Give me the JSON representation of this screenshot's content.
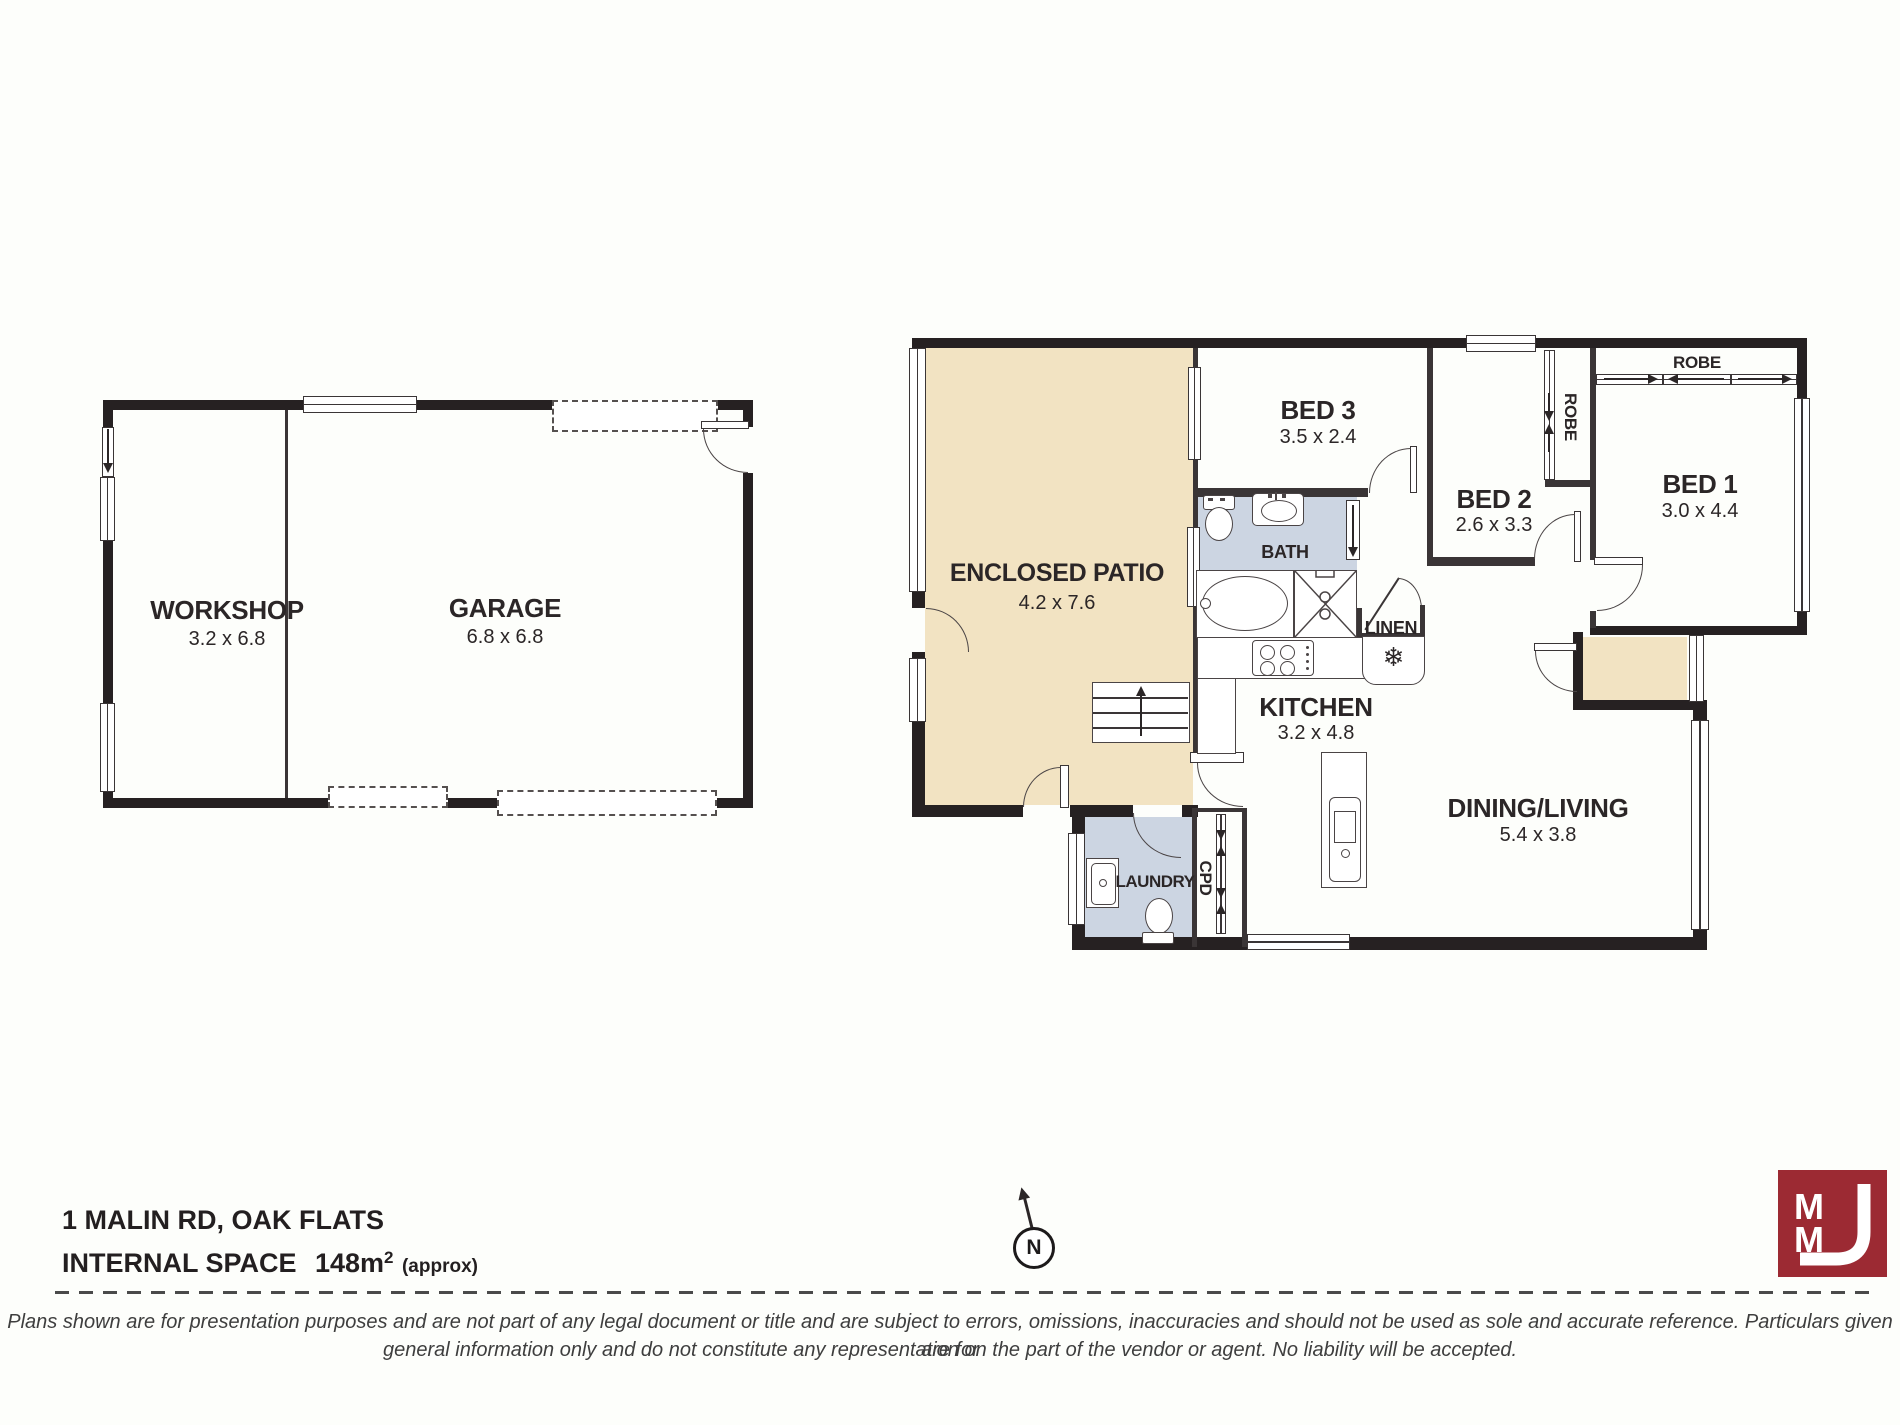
{
  "rooms": {
    "workshop": {
      "name": "WORKSHOP",
      "dims": "3.2 x 6.8"
    },
    "garage": {
      "name": "GARAGE",
      "dims": "6.8 x 6.8"
    },
    "enclosed_patio": {
      "name": "ENCLOSED PATIO",
      "dims": "4.2 x 7.6"
    },
    "bed3": {
      "name": "BED 3",
      "dims": "3.5 x 2.4"
    },
    "bed2": {
      "name": "BED 2",
      "dims": "2.6 x 3.3"
    },
    "bed1": {
      "name": "BED 1",
      "dims": "3.0 x 4.4"
    },
    "bath": {
      "name": "BATH"
    },
    "linen": {
      "name": "LINEN"
    },
    "kitchen": {
      "name": "KITCHEN",
      "dims": "3.2 x 4.8"
    },
    "dining_living": {
      "name": "DINING/LIVING",
      "dims": "5.4 x 3.8"
    },
    "laundry": {
      "name": "LAUNDRY"
    },
    "cpd": {
      "name": "CPD"
    },
    "robe_bed1": {
      "name": "ROBE"
    },
    "robe_bed2": {
      "name": "ROBE"
    }
  },
  "icons": {
    "fridge_snowflake": "❄"
  },
  "footer": {
    "address": "1 MALIN RD, OAK FLATS",
    "internal_space_label": "INTERNAL SPACE",
    "internal_space_value": "148m",
    "internal_space_sup": "2",
    "internal_space_approx": "(approx)",
    "north_letter": "N",
    "disclaimer_line1": "Plans shown are for presentation purposes and are not part of any legal document or title and are subject to errors, omissions, inaccuracies and should not be used as sole and accurate reference. Particulars given are for",
    "disclaimer_line2": "general information only and do not constitute any representation on the part of the vendor or agent. No liability will be accepted."
  },
  "logo": {
    "text": "MMJ",
    "m_top": "M",
    "m_bottom": "M"
  },
  "colors": {
    "wall": "#262122",
    "patio_fill": "#f2e3c2",
    "wet_area_fill": "#ccd5e2",
    "logo_red": "#9c2a33",
    "disclaimer_gray": "#3e3e3e"
  }
}
